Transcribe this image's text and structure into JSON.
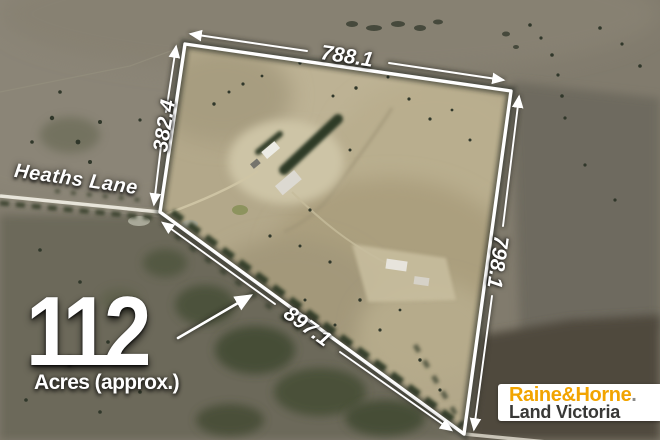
{
  "road": {
    "label": "Heaths Lane"
  },
  "dimensions": {
    "top": "788.1",
    "left": "382.4",
    "right": "798.1",
    "bottom": "897.1"
  },
  "area": {
    "value": "112",
    "unit": "Acres (approx.)"
  },
  "logo": {
    "brand": "Raine&Horne",
    "dot": ".",
    "region": "Land Victoria",
    "brand_color": "#F2A400",
    "region_text_color": "#383836",
    "background": "#FFFFFF"
  },
  "boundary": {
    "color": "#FFFFFF"
  }
}
